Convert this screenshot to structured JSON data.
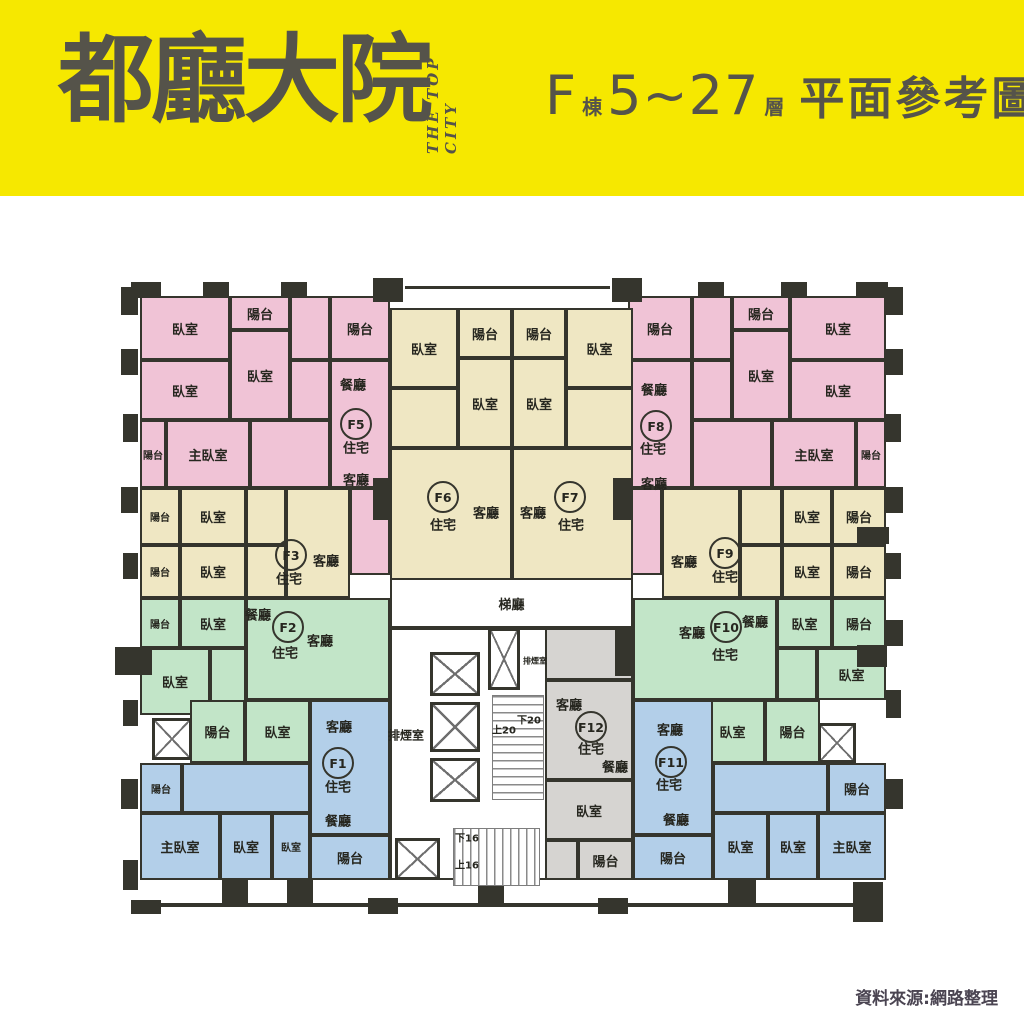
{
  "header": {
    "logo": "都廳大院",
    "logo_sub": "THE TOP CITY",
    "building": "F",
    "building_suffix": "棟",
    "floor_range": "5~27",
    "floor_suffix": "層",
    "title": "平面參考圖"
  },
  "footer": {
    "source": "資料來源:網路整理"
  },
  "colors": {
    "yellow": "#f6e800",
    "pink": "#f0c3d6",
    "cream": "#efe7c3",
    "green": "#c2e5c8",
    "blue": "#b3cfe9",
    "gray": "#d6d4d1",
    "white": "#ffffff",
    "wall": "#35352d"
  },
  "plan": {
    "unit_colors": {
      "F1": "blue",
      "F2": "green",
      "F3": "cream",
      "F5": "pink",
      "F6": "cream",
      "F7": "cream",
      "F8": "pink",
      "F9": "cream",
      "F10": "green",
      "F11": "blue",
      "F12": "gray",
      "core": "white"
    },
    "rooms": [
      {
        "u": "core",
        "l": "",
        "x": 390,
        "y": 628,
        "w": 243,
        "h": 252
      },
      {
        "u": "core",
        "l": "梯廳",
        "x": 390,
        "y": 578,
        "w": 243,
        "h": 50
      },
      {
        "u": "F5",
        "l": "臥室",
        "x": 140,
        "y": 296,
        "w": 90,
        "h": 64
      },
      {
        "u": "F5",
        "l": "陽台",
        "x": 230,
        "y": 296,
        "w": 60,
        "h": 34
      },
      {
        "u": "F5",
        "l": "臥室",
        "x": 230,
        "y": 330,
        "w": 60,
        "h": 90
      },
      {
        "u": "F5",
        "l": "",
        "x": 290,
        "y": 296,
        "w": 40,
        "h": 64
      },
      {
        "u": "F5",
        "l": "陽台",
        "x": 330,
        "y": 296,
        "w": 60,
        "h": 64
      },
      {
        "u": "F5",
        "l": "臥室",
        "x": 140,
        "y": 360,
        "w": 90,
        "h": 60
      },
      {
        "u": "F5",
        "l": "",
        "x": 290,
        "y": 360,
        "w": 40,
        "h": 60
      },
      {
        "u": "F5",
        "l": "",
        "x": 330,
        "y": 360,
        "w": 60,
        "h": 128
      },
      {
        "u": "F5",
        "l": "陽台",
        "x": 140,
        "y": 420,
        "w": 26,
        "h": 68
      },
      {
        "u": "F5",
        "l": "主臥室",
        "x": 166,
        "y": 420,
        "w": 84,
        "h": 68
      },
      {
        "u": "F5",
        "l": "",
        "x": 250,
        "y": 420,
        "w": 80,
        "h": 68
      },
      {
        "u": "F5",
        "l": "",
        "x": 350,
        "y": 488,
        "w": 40,
        "h": 87
      },
      {
        "u": "F8",
        "l": "陽台",
        "x": 628,
        "y": 296,
        "w": 64,
        "h": 64
      },
      {
        "u": "F8",
        "l": "",
        "x": 692,
        "y": 296,
        "w": 40,
        "h": 64
      },
      {
        "u": "F8",
        "l": "陽台",
        "x": 732,
        "y": 296,
        "w": 58,
        "h": 34
      },
      {
        "u": "F8",
        "l": "臥室",
        "x": 732,
        "y": 330,
        "w": 58,
        "h": 90
      },
      {
        "u": "F8",
        "l": "臥室",
        "x": 790,
        "y": 296,
        "w": 96,
        "h": 64
      },
      {
        "u": "F8",
        "l": "",
        "x": 628,
        "y": 360,
        "w": 64,
        "h": 128
      },
      {
        "u": "F8",
        "l": "",
        "x": 692,
        "y": 360,
        "w": 40,
        "h": 60
      },
      {
        "u": "F8",
        "l": "臥室",
        "x": 790,
        "y": 360,
        "w": 96,
        "h": 60
      },
      {
        "u": "F8",
        "l": "",
        "x": 692,
        "y": 420,
        "w": 80,
        "h": 68
      },
      {
        "u": "F8",
        "l": "主臥室",
        "x": 772,
        "y": 420,
        "w": 84,
        "h": 68
      },
      {
        "u": "F8",
        "l": "陽台",
        "x": 856,
        "y": 420,
        "w": 30,
        "h": 68
      },
      {
        "u": "F8",
        "l": "",
        "x": 628,
        "y": 488,
        "w": 34,
        "h": 87
      },
      {
        "u": "F6",
        "l": "臥室",
        "x": 390,
        "y": 308,
        "w": 68,
        "h": 80
      },
      {
        "u": "F6",
        "l": "陽台",
        "x": 458,
        "y": 308,
        "w": 54,
        "h": 50
      },
      {
        "u": "F6",
        "l": "臥室",
        "x": 458,
        "y": 358,
        "w": 54,
        "h": 90
      },
      {
        "u": "F6",
        "l": "",
        "x": 390,
        "y": 388,
        "w": 68,
        "h": 60
      },
      {
        "u": "F6",
        "l": "",
        "x": 390,
        "y": 448,
        "w": 122,
        "h": 132
      },
      {
        "u": "F7",
        "l": "陽台",
        "x": 512,
        "y": 308,
        "w": 54,
        "h": 50
      },
      {
        "u": "F7",
        "l": "臥室",
        "x": 566,
        "y": 308,
        "w": 67,
        "h": 80
      },
      {
        "u": "F7",
        "l": "臥室",
        "x": 512,
        "y": 358,
        "w": 54,
        "h": 90
      },
      {
        "u": "F7",
        "l": "",
        "x": 566,
        "y": 388,
        "w": 67,
        "h": 60
      },
      {
        "u": "F7",
        "l": "",
        "x": 512,
        "y": 448,
        "w": 121,
        "h": 132
      },
      {
        "u": "F3",
        "l": "陽台",
        "x": 140,
        "y": 488,
        "w": 40,
        "h": 57
      },
      {
        "u": "F3",
        "l": "臥室",
        "x": 180,
        "y": 488,
        "w": 66,
        "h": 57
      },
      {
        "u": "F3",
        "l": "",
        "x": 246,
        "y": 488,
        "w": 40,
        "h": 57
      },
      {
        "u": "F3",
        "l": "",
        "x": 286,
        "y": 488,
        "w": 64,
        "h": 110
      },
      {
        "u": "F3",
        "l": "陽台",
        "x": 140,
        "y": 545,
        "w": 40,
        "h": 53
      },
      {
        "u": "F3",
        "l": "臥室",
        "x": 180,
        "y": 545,
        "w": 66,
        "h": 53
      },
      {
        "u": "F3",
        "l": "",
        "x": 246,
        "y": 545,
        "w": 40,
        "h": 53
      },
      {
        "u": "F9",
        "l": "",
        "x": 662,
        "y": 488,
        "w": 78,
        "h": 110
      },
      {
        "u": "F9",
        "l": "",
        "x": 740,
        "y": 488,
        "w": 42,
        "h": 57
      },
      {
        "u": "F9",
        "l": "臥室",
        "x": 782,
        "y": 488,
        "w": 50,
        "h": 57
      },
      {
        "u": "F9",
        "l": "陽台",
        "x": 832,
        "y": 488,
        "w": 54,
        "h": 57
      },
      {
        "u": "F9",
        "l": "",
        "x": 740,
        "y": 545,
        "w": 42,
        "h": 53
      },
      {
        "u": "F9",
        "l": "臥室",
        "x": 782,
        "y": 545,
        "w": 50,
        "h": 53
      },
      {
        "u": "F9",
        "l": "陽台",
        "x": 832,
        "y": 545,
        "w": 54,
        "h": 53
      },
      {
        "u": "F2",
        "l": "陽台",
        "x": 140,
        "y": 598,
        "w": 40,
        "h": 50
      },
      {
        "u": "F2",
        "l": "臥室",
        "x": 180,
        "y": 598,
        "w": 66,
        "h": 50
      },
      {
        "u": "F2",
        "l": "",
        "x": 246,
        "y": 598,
        "w": 144,
        "h": 102
      },
      {
        "u": "F2",
        "l": "臥室",
        "x": 140,
        "y": 648,
        "w": 70,
        "h": 67
      },
      {
        "u": "F2",
        "l": "",
        "x": 210,
        "y": 648,
        "w": 36,
        "h": 67
      },
      {
        "u": "F2",
        "l": "陽台",
        "x": 190,
        "y": 700,
        "w": 55,
        "h": 63
      },
      {
        "u": "F2",
        "l": "臥室",
        "x": 245,
        "y": 700,
        "w": 65,
        "h": 63
      },
      {
        "u": "F10",
        "l": "",
        "x": 633,
        "y": 598,
        "w": 144,
        "h": 102
      },
      {
        "u": "F10",
        "l": "臥室",
        "x": 777,
        "y": 598,
        "w": 55,
        "h": 50
      },
      {
        "u": "F10",
        "l": "陽台",
        "x": 832,
        "y": 598,
        "w": 54,
        "h": 50
      },
      {
        "u": "F10",
        "l": "",
        "x": 777,
        "y": 648,
        "w": 40,
        "h": 52
      },
      {
        "u": "F10",
        "l": "臥室",
        "x": 817,
        "y": 648,
        "w": 69,
        "h": 52
      },
      {
        "u": "F10",
        "l": "臥室",
        "x": 700,
        "y": 700,
        "w": 65,
        "h": 63
      },
      {
        "u": "F10",
        "l": "陽台",
        "x": 765,
        "y": 700,
        "w": 55,
        "h": 63
      },
      {
        "u": "F1",
        "l": "",
        "x": 310,
        "y": 700,
        "w": 80,
        "h": 135
      },
      {
        "u": "F1",
        "l": "陽台",
        "x": 140,
        "y": 763,
        "w": 42,
        "h": 50
      },
      {
        "u": "F1",
        "l": "",
        "x": 182,
        "y": 763,
        "w": 128,
        "h": 50
      },
      {
        "u": "F1",
        "l": "主臥室",
        "x": 140,
        "y": 813,
        "w": 80,
        "h": 67
      },
      {
        "u": "F1",
        "l": "臥室",
        "x": 220,
        "y": 813,
        "w": 52,
        "h": 67
      },
      {
        "u": "F1",
        "l": "臥室",
        "x": 272,
        "y": 813,
        "w": 38,
        "h": 67
      },
      {
        "u": "F1",
        "l": "陽台",
        "x": 310,
        "y": 835,
        "w": 80,
        "h": 45
      },
      {
        "u": "F11",
        "l": "",
        "x": 633,
        "y": 700,
        "w": 80,
        "h": 135
      },
      {
        "u": "F11",
        "l": "陽台",
        "x": 633,
        "y": 835,
        "w": 80,
        "h": 45
      },
      {
        "u": "F11",
        "l": "",
        "x": 713,
        "y": 763,
        "w": 115,
        "h": 50
      },
      {
        "u": "F11",
        "l": "陽台",
        "x": 828,
        "y": 763,
        "w": 58,
        "h": 50
      },
      {
        "u": "F11",
        "l": "臥室",
        "x": 713,
        "y": 813,
        "w": 55,
        "h": 67
      },
      {
        "u": "F11",
        "l": "臥室",
        "x": 768,
        "y": 813,
        "w": 50,
        "h": 67
      },
      {
        "u": "F11",
        "l": "主臥室",
        "x": 818,
        "y": 813,
        "w": 68,
        "h": 67
      },
      {
        "u": "F12",
        "l": "",
        "x": 545,
        "y": 628,
        "w": 88,
        "h": 52
      },
      {
        "u": "F12",
        "l": "",
        "x": 545,
        "y": 680,
        "w": 88,
        "h": 100
      },
      {
        "u": "F12",
        "l": "臥室",
        "x": 545,
        "y": 780,
        "w": 88,
        "h": 60
      },
      {
        "u": "F12",
        "l": "",
        "x": 545,
        "y": 840,
        "w": 33,
        "h": 40
      },
      {
        "u": "F12",
        "l": "陽台",
        "x": 578,
        "y": 840,
        "w": 55,
        "h": 40
      }
    ],
    "circles": [
      {
        "id": "F1",
        "x": 338,
        "y": 763
      },
      {
        "id": "F2",
        "x": 288,
        "y": 627
      },
      {
        "id": "F3",
        "x": 291,
        "y": 555
      },
      {
        "id": "F5",
        "x": 356,
        "y": 424
      },
      {
        "id": "F6",
        "x": 443,
        "y": 497
      },
      {
        "id": "F7",
        "x": 570,
        "y": 497
      },
      {
        "id": "F8",
        "x": 656,
        "y": 426
      },
      {
        "id": "F9",
        "x": 725,
        "y": 553
      },
      {
        "id": "F10",
        "x": 726,
        "y": 627
      },
      {
        "id": "F11",
        "x": 671,
        "y": 762
      },
      {
        "id": "F12",
        "x": 591,
        "y": 727
      }
    ],
    "free_labels": [
      {
        "t": "餐廳",
        "x": 353,
        "y": 384
      },
      {
        "t": "住宅",
        "x": 356,
        "y": 447
      },
      {
        "t": "客廳",
        "x": 356,
        "y": 479
      },
      {
        "t": "餐廳",
        "x": 654,
        "y": 389
      },
      {
        "t": "住宅",
        "x": 653,
        "y": 448
      },
      {
        "t": "客廳",
        "x": 654,
        "y": 483
      },
      {
        "t": "客廳",
        "x": 486,
        "y": 512
      },
      {
        "t": "住宅",
        "x": 443,
        "y": 524
      },
      {
        "t": "客廳",
        "x": 533,
        "y": 512
      },
      {
        "t": "住宅",
        "x": 571,
        "y": 524
      },
      {
        "t": "客廳",
        "x": 326,
        "y": 560
      },
      {
        "t": "住宅",
        "x": 289,
        "y": 578
      },
      {
        "t": "客廳",
        "x": 684,
        "y": 561
      },
      {
        "t": "住宅",
        "x": 725,
        "y": 576
      },
      {
        "t": "餐廳",
        "x": 258,
        "y": 614
      },
      {
        "t": "客廳",
        "x": 320,
        "y": 640
      },
      {
        "t": "住宅",
        "x": 285,
        "y": 652
      },
      {
        "t": "客廳",
        "x": 692,
        "y": 632
      },
      {
        "t": "餐廳",
        "x": 755,
        "y": 621
      },
      {
        "t": "住宅",
        "x": 725,
        "y": 654
      },
      {
        "t": "客廳",
        "x": 339,
        "y": 726
      },
      {
        "t": "住宅",
        "x": 338,
        "y": 786
      },
      {
        "t": "餐廳",
        "x": 338,
        "y": 820
      },
      {
        "t": "客廳",
        "x": 670,
        "y": 729
      },
      {
        "t": "住宅",
        "x": 669,
        "y": 784
      },
      {
        "t": "餐廳",
        "x": 676,
        "y": 819
      },
      {
        "t": "客廳",
        "x": 569,
        "y": 704
      },
      {
        "t": "住宅",
        "x": 591,
        "y": 748
      },
      {
        "t": "餐廳",
        "x": 615,
        "y": 766
      },
      {
        "t": "排煙室",
        "x": 406,
        "y": 735,
        "s": 12
      },
      {
        "t": "排煙室",
        "x": 535,
        "y": 661,
        "s": 8
      },
      {
        "t": "上20",
        "x": 504,
        "y": 729,
        "s": 10
      },
      {
        "t": "下20",
        "x": 529,
        "y": 719,
        "s": 10
      },
      {
        "t": "下16",
        "x": 467,
        "y": 837,
        "s": 10
      },
      {
        "t": "上16",
        "x": 467,
        "y": 864,
        "s": 10
      }
    ],
    "shafts": [
      {
        "x": 430,
        "y": 652,
        "w": 50,
        "h": 44,
        "n": "elevator-icon"
      },
      {
        "x": 430,
        "y": 702,
        "w": 50,
        "h": 50,
        "n": "elevator-icon"
      },
      {
        "x": 430,
        "y": 758,
        "w": 50,
        "h": 44,
        "n": "elevator-icon"
      },
      {
        "x": 488,
        "y": 628,
        "w": 32,
        "h": 62,
        "n": "smoke-shaft-icon"
      },
      {
        "x": 152,
        "y": 718,
        "w": 40,
        "h": 42,
        "n": "shaft-icon"
      },
      {
        "x": 818,
        "y": 723,
        "w": 38,
        "h": 40,
        "n": "shaft-icon"
      },
      {
        "x": 395,
        "y": 838,
        "w": 45,
        "h": 42,
        "n": "shaft-icon"
      }
    ],
    "stairs": [
      {
        "x": 492,
        "y": 695,
        "w": 52,
        "h": 105,
        "d": "v"
      },
      {
        "x": 453,
        "y": 828,
        "w": 87,
        "h": 58,
        "d": "h"
      }
    ],
    "walls": [
      {
        "x": 131,
        "y": 282,
        "w": 30,
        "h": 16
      },
      {
        "x": 203,
        "y": 282,
        "w": 26,
        "h": 16
      },
      {
        "x": 281,
        "y": 282,
        "w": 26,
        "h": 16
      },
      {
        "x": 373,
        "y": 278,
        "w": 30,
        "h": 24
      },
      {
        "x": 612,
        "y": 278,
        "w": 30,
        "h": 24
      },
      {
        "x": 698,
        "y": 282,
        "w": 26,
        "h": 16
      },
      {
        "x": 781,
        "y": 282,
        "w": 26,
        "h": 16
      },
      {
        "x": 856,
        "y": 282,
        "w": 32,
        "h": 16
      },
      {
        "x": 405,
        "y": 286,
        "w": 205,
        "h": 3
      },
      {
        "x": 121,
        "y": 287,
        "w": 17,
        "h": 28
      },
      {
        "x": 121,
        "y": 349,
        "w": 17,
        "h": 26
      },
      {
        "x": 123,
        "y": 414,
        "w": 15,
        "h": 28
      },
      {
        "x": 121,
        "y": 487,
        "w": 17,
        "h": 26
      },
      {
        "x": 123,
        "y": 553,
        "w": 15,
        "h": 26
      },
      {
        "x": 115,
        "y": 647,
        "w": 37,
        "h": 28
      },
      {
        "x": 123,
        "y": 700,
        "w": 15,
        "h": 26
      },
      {
        "x": 121,
        "y": 779,
        "w": 17,
        "h": 30
      },
      {
        "x": 123,
        "y": 860,
        "w": 15,
        "h": 30
      },
      {
        "x": 886,
        "y": 287,
        "w": 17,
        "h": 28
      },
      {
        "x": 886,
        "y": 349,
        "w": 17,
        "h": 26
      },
      {
        "x": 886,
        "y": 414,
        "w": 15,
        "h": 28
      },
      {
        "x": 886,
        "y": 487,
        "w": 17,
        "h": 26
      },
      {
        "x": 857,
        "y": 527,
        "w": 32,
        "h": 17
      },
      {
        "x": 886,
        "y": 553,
        "w": 15,
        "h": 26
      },
      {
        "x": 886,
        "y": 620,
        "w": 17,
        "h": 26
      },
      {
        "x": 857,
        "y": 645,
        "w": 30,
        "h": 22
      },
      {
        "x": 886,
        "y": 690,
        "w": 15,
        "h": 28
      },
      {
        "x": 886,
        "y": 779,
        "w": 17,
        "h": 30
      },
      {
        "x": 853,
        "y": 882,
        "w": 30,
        "h": 40
      },
      {
        "x": 222,
        "y": 878,
        "w": 26,
        "h": 28
      },
      {
        "x": 287,
        "y": 878,
        "w": 26,
        "h": 28
      },
      {
        "x": 478,
        "y": 878,
        "w": 26,
        "h": 28
      },
      {
        "x": 728,
        "y": 878,
        "w": 28,
        "h": 28
      },
      {
        "x": 131,
        "y": 900,
        "w": 30,
        "h": 14
      },
      {
        "x": 368,
        "y": 898,
        "w": 30,
        "h": 16
      },
      {
        "x": 598,
        "y": 898,
        "w": 30,
        "h": 16
      },
      {
        "x": 140,
        "y": 903,
        "w": 715,
        "h": 4
      },
      {
        "x": 373,
        "y": 478,
        "w": 18,
        "h": 42
      },
      {
        "x": 613,
        "y": 478,
        "w": 18,
        "h": 42
      },
      {
        "x": 615,
        "y": 628,
        "w": 18,
        "h": 48
      }
    ]
  }
}
